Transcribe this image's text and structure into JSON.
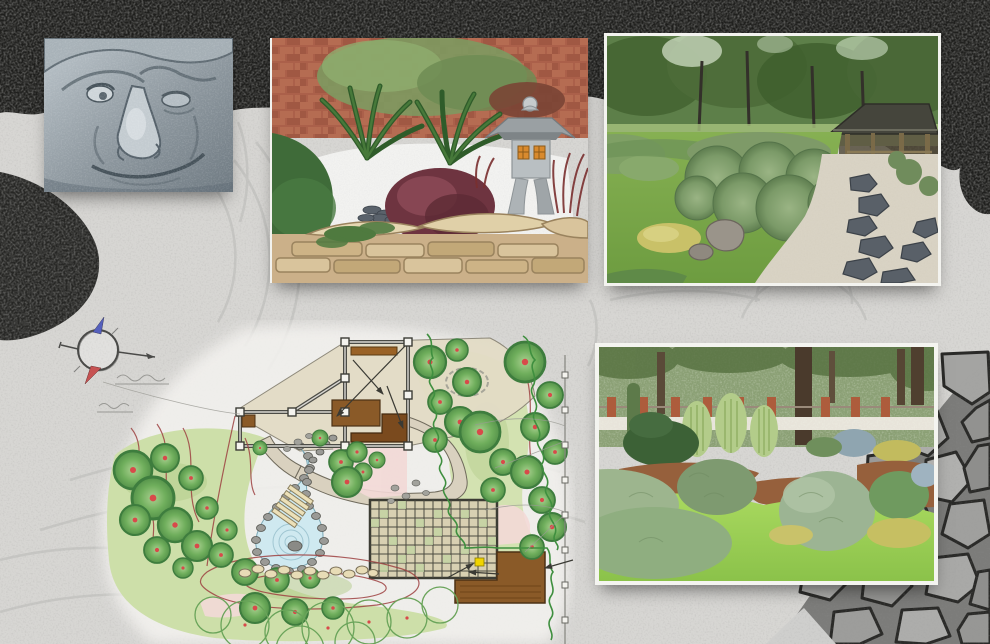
{
  "board": {
    "title": "Japanese garden design collage",
    "background": {
      "description": "Black-and-white zen garden backdrop: raked gravel with swirl patterns, dark clipped hedge band across the top, dark bush at the left edge and a grey flagstone path in the lower-right corner",
      "gravel_color": "#d7d6d3",
      "foliage_color": "#1f1f1d",
      "flagstone_joint_color": "#2a2a28"
    },
    "photos": [
      {
        "id": "stone-face",
        "position": "top-left",
        "alt": "Close-up photo of a weathered carved stone face sculpture"
      },
      {
        "id": "lantern-garden",
        "position": "top-center",
        "alt": "Rock garden corner with brick wall, ferns, white gravel, burgundy barberry shrub, Japanese stone pagoda lantern and sandstone retaining wall"
      },
      {
        "id": "clipped-garden",
        "position": "top-right",
        "alt": "Japanese garden with large clipped round shrubs, lawn, boulders, gravel with dark stepping-stone path and a timber shelter under trees"
      },
      {
        "id": "conifer-garden",
        "position": "bottom-right",
        "alt": "Conifer and topiary planting beds with weeping trees, silver and golden shrubs, bark mulch and bright lawn in front of a brick fence and tall trunks"
      }
    ],
    "plan": {
      "alt": "Hand-drawn landscape master plan with pond, step bridge, timber pergola, wooden decks, grid paving, tree planting and boundary fence",
      "features": [
        "pond with stone edging and ripples",
        "plank step bridge",
        "timber pergola frame with posts",
        "brown wooden decks",
        "square grid paving with one yellow highlighted cell",
        "round trees with red centre markers",
        "outlined future-tree circles",
        "red contour lines",
        "stepping-stone path",
        "scalloped green shrub border",
        "boundary fence line with square markers",
        "leader arrows",
        "two illegible pencil notes"
      ],
      "colors": {
        "lawn": "#cddfa9",
        "water": "#cfe9f0",
        "deck_brown": "#8a5a28",
        "paving_beige": "#e3dcc6",
        "path_pink": "#f3d9d7",
        "tree_green": "#6fae5c",
        "contour_red": "#9e4242",
        "highlight_cell": "#f0d400"
      },
      "compass": {
        "north_color": "#5560bd",
        "south_color": "#c65252"
      }
    }
  }
}
